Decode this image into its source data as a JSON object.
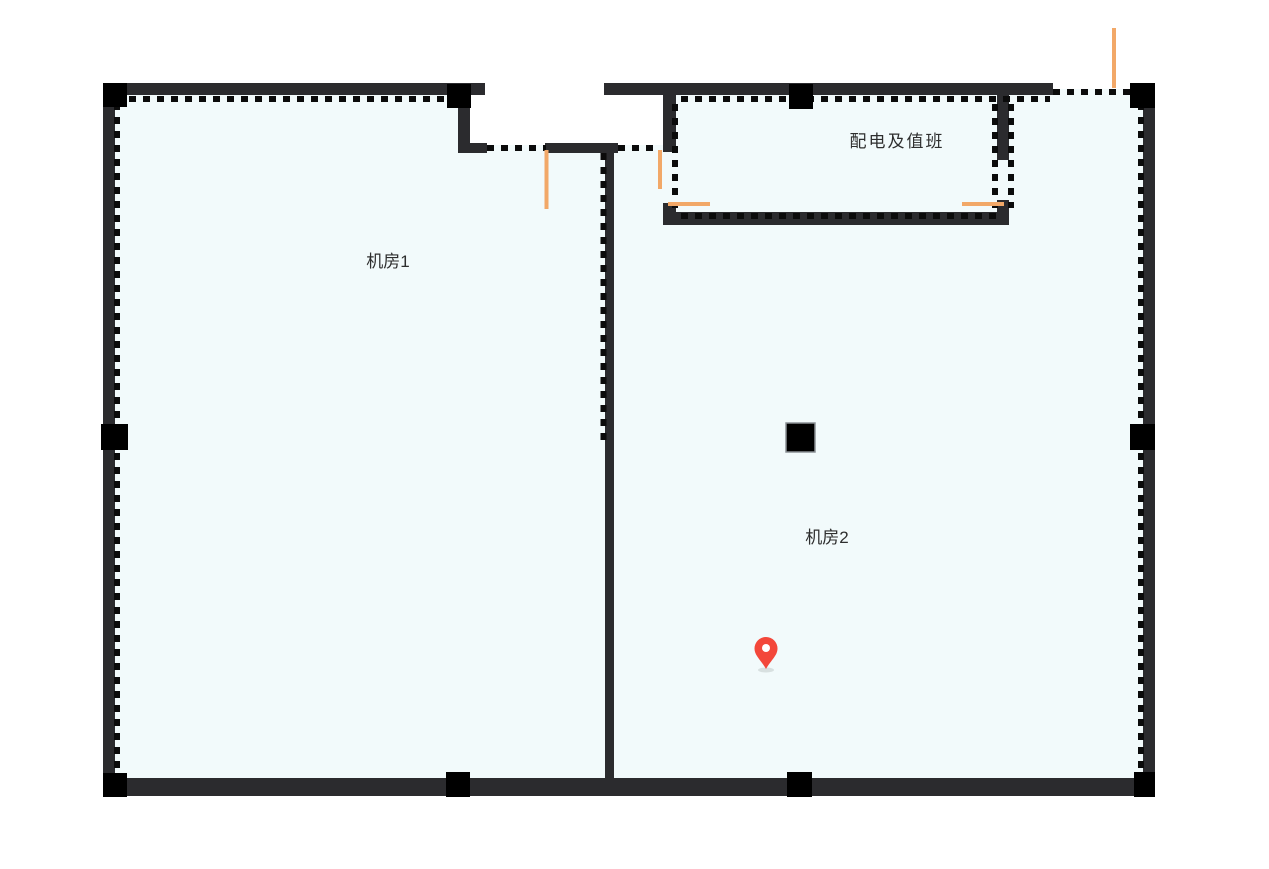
{
  "floorplan": {
    "rooms": [
      {
        "id": "room-1",
        "label": "机房1"
      },
      {
        "id": "room-2",
        "label": "机房2"
      },
      {
        "id": "power-duty-room",
        "label": "配电及值班"
      }
    ],
    "marker": {
      "id": "location-pin",
      "shape": "map-pin",
      "room": "机房2"
    },
    "colors": {
      "background": "#ffffff",
      "wall": "#2b2b2e",
      "pillar": "#000000",
      "dash": "#0b0b0b",
      "room_fill": "#f2fafb",
      "door_swing": "#f2a868",
      "marker_red": "#f3473a",
      "marker_hole": "#ffffff",
      "label": "#2e2e2e"
    }
  }
}
